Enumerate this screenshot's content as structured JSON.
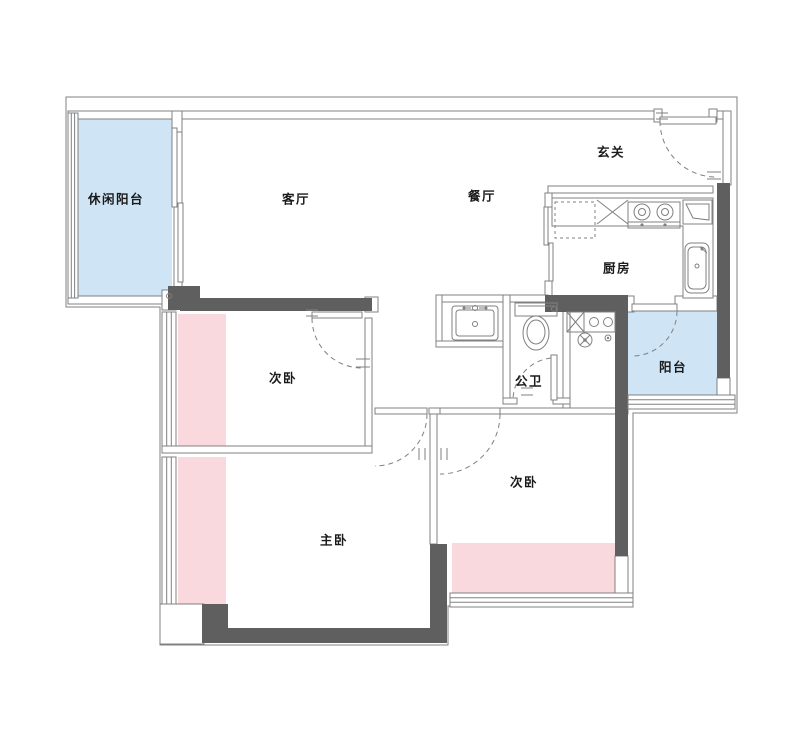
{
  "floorplan": {
    "rooms": [
      {
        "id": "leisure-balcony",
        "label": "休闲阳台"
      },
      {
        "id": "living-room",
        "label": "客厅"
      },
      {
        "id": "dining-room",
        "label": "餐厅"
      },
      {
        "id": "entry-hall",
        "label": "玄关"
      },
      {
        "id": "kitchen",
        "label": "厨房"
      },
      {
        "id": "balcony",
        "label": "阳台"
      },
      {
        "id": "bathroom",
        "label": "公卫"
      },
      {
        "id": "bedroom-left",
        "label": "次卧"
      },
      {
        "id": "bedroom-right",
        "label": "次卧"
      },
      {
        "id": "master-bedroom",
        "label": "主卧"
      }
    ],
    "fixtures": [
      "entry-door-swing",
      "bedroom-door-swing",
      "bathroom-door-swing",
      "balcony-door-swing",
      "sliding-door",
      "window",
      "toilet",
      "washbasin",
      "kitchen-stove",
      "kitchen-sink",
      "corner-sink",
      "fridge",
      "washing-machine",
      "floor-drain"
    ],
    "colors": {
      "balcony_fill": "#cfe4f4",
      "highlight_fill": "#f9d9dd",
      "wall_dark": "#5f5f5f",
      "line_color": "#808080",
      "label_color": "#1a1a1a"
    }
  }
}
